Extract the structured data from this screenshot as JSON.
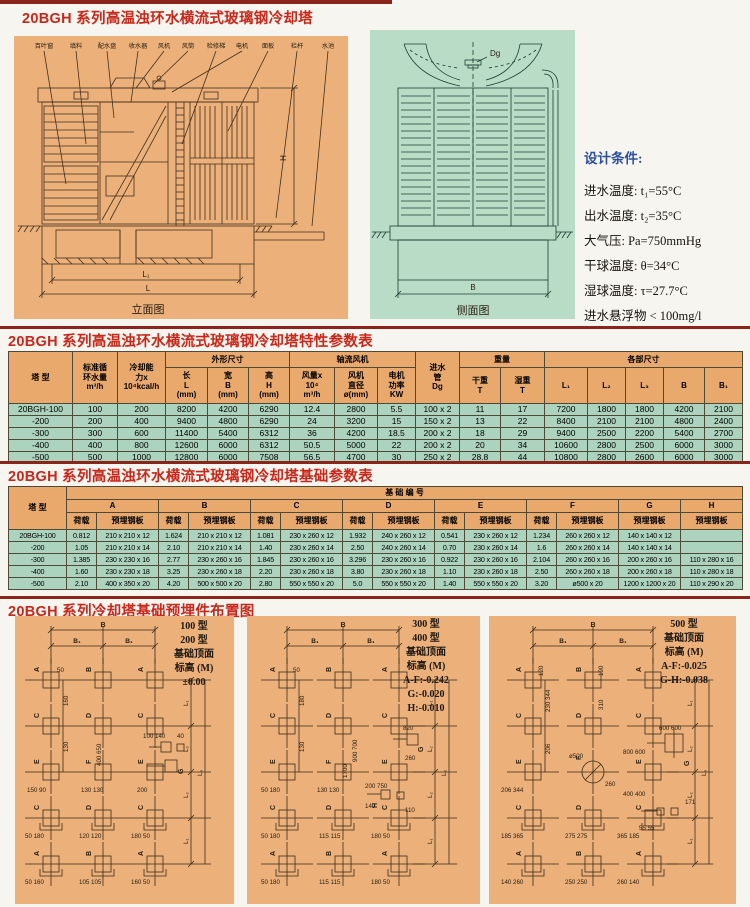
{
  "page": {
    "title1": "20BGH 系列高温浊环水横流式玻璃钢冷却塔",
    "title2": "20BGH 系列高温浊环水横流式玻璃钢冷却塔特性参数表",
    "title3": "20BGH 系列高温浊环水横流式玻璃钢冷却塔基础参数表",
    "title4": "20BGH 系列冷却塔基础预埋件布置图"
  },
  "colors": {
    "title_red": "#c9271a",
    "rule_red": "#8b241b",
    "panel_orange": "#ecb07a",
    "panel_green": "#b9dcc6",
    "table_header_orange": "#e9a96c",
    "table_cell_green": "#abd3bd",
    "heading_blue": "#2b50a1"
  },
  "elev": {
    "caption": "立面图",
    "labels": [
      "百叶窗",
      "填料",
      "配水盘",
      "收水器",
      "风机",
      "风筒",
      "检修梯",
      "电机",
      "面板",
      "栏杆",
      "水池"
    ],
    "dims": {
      "h": "H",
      "l1": "L₁",
      "l": "L"
    }
  },
  "side": {
    "caption": "侧面图",
    "dg": "Dg",
    "b": "B"
  },
  "cond": {
    "heading": "设计条件:",
    "lines": [
      "进水温度:  t₁=55°C",
      "出水温度:  t₂=35°C",
      "大气压:  Pa=750mmHg",
      "干球温度:  θ=34°C",
      "湿球温度:  τ=27.7°C",
      "进水悬浮物 < 100mg/l"
    ]
  },
  "t1": {
    "h": {
      "tower": "塔  型",
      "flow": "标准循\n环水量\nm³/h",
      "cooling": "冷却能\n力x\n10⁴kcal/h",
      "dims_group": "外形尺寸",
      "len": "长\nL\n(mm)",
      "wid": "宽\nB\n(mm)",
      "hgt": "高\nH\n(mm)",
      "fan_group": "轴流风机",
      "airflow": "风量x\n10⁴\nm³/h",
      "fan_dia": "风机\n直径\nø(mm)",
      "motor": "电机\n功率\nKW",
      "inlet": "进水\n管\nDg",
      "weight_group": "重量",
      "dry": "干重\nT",
      "wet": "湿重\nT",
      "parts_group": "各部尺寸",
      "l1": "L₁",
      "l2": "L₂",
      "l3": "L₃",
      "b": "B",
      "b1": "B₁"
    },
    "rows": [
      [
        "20BGH-100",
        "100",
        "200",
        "8200",
        "4200",
        "6290",
        "12.4",
        "2800",
        "5.5",
        "100 x 2",
        "11",
        "17",
        "7200",
        "1800",
        "1800",
        "4200",
        "2100"
      ],
      [
        "-200",
        "200",
        "400",
        "9400",
        "4800",
        "6290",
        "24",
        "3200",
        "15",
        "150 x 2",
        "13",
        "22",
        "8400",
        "2100",
        "2100",
        "4800",
        "2400"
      ],
      [
        "-300",
        "300",
        "600",
        "11400",
        "5400",
        "6312",
        "36",
        "4200",
        "18.5",
        "200 x 2",
        "18",
        "29",
        "9400",
        "2500",
        "2200",
        "5400",
        "2700"
      ],
      [
        "-400",
        "400",
        "800",
        "12600",
        "6000",
        "6312",
        "50.5",
        "5000",
        "22",
        "200 x 2",
        "20",
        "34",
        "10600",
        "2800",
        "2500",
        "6000",
        "3000"
      ],
      [
        "-500",
        "500",
        "1000",
        "12800",
        "6000",
        "7508",
        "56.5",
        "4700",
        "30",
        "250 x 2",
        "28.8",
        "44",
        "10800",
        "2800",
        "2600",
        "6000",
        "3000"
      ]
    ]
  },
  "t2": {
    "h": {
      "tower": "塔  型",
      "group": "基  础  编  号",
      "cols": [
        "A",
        "B",
        "C",
        "D",
        "E",
        "F",
        "G",
        "H"
      ],
      "load": "荷载",
      "plate": "预埋钢板"
    },
    "rows": [
      [
        "20BGH-100",
        "0.812",
        "210 x 210 x 12",
        "1.624",
        "210 x 210 x 12",
        "1.081",
        "230 x 260 x 12",
        "1.932",
        "240 x 260 x 12",
        "0.541",
        "230 x 260 x 12",
        "1.234",
        "260 x 260 x 12",
        "140 x 140 x 12",
        ""
      ],
      [
        "-200",
        "1.05",
        "210 x 210 x 14",
        "2.10",
        "210 x 210 x 14",
        "1.40",
        "230 x 260 x 14",
        "2.50",
        "240 x 260 x 14",
        "0.70",
        "230 x 260 x 14",
        "1.6",
        "260 x 260 x 14",
        "140 x 140 x 14",
        ""
      ],
      [
        "-300",
        "1.385",
        "230 x 230 x 16",
        "2.77",
        "230 x 260 x 16",
        "1.845",
        "230 x 260 x 16",
        "3.296",
        "230 x 260 x 16",
        "0.922",
        "230 x 260 x 16",
        "2.104",
        "260 x 260 x 16",
        "200 x 260 x 16",
        "110 x 280 x 16"
      ],
      [
        "-400",
        "1.60",
        "230 x 230 x 18",
        "3.25",
        "230 x 260 x 18",
        "2.20",
        "230 x 260 x 18",
        "3.80",
        "230 x 260 x 18",
        "1.10",
        "230 x 260 x 18",
        "2.50",
        "260 x 260 x 18",
        "200 x 260 x 18",
        "110 x 280 x 18"
      ],
      [
        "-500",
        "2.10",
        "400 x 350 x 20",
        "4.20",
        "500 x 500 x 20",
        "2.80",
        "550 x 550 x 20",
        "5.0",
        "550 x 550 x 20",
        "1.40",
        "550 x 550 x 20",
        "3.20",
        "ø500 x 20",
        "1200 x 1200 x 20",
        "110 x 290 x 20"
      ]
    ]
  },
  "diag": [
    {
      "side": [
        "100 型",
        "200 型",
        "基础顶面",
        "标高 (M)",
        "±0.00"
      ],
      "top": {
        "b": "B",
        "b1": "B₁"
      },
      "letters": [
        "A",
        "B",
        "A",
        "C",
        "D",
        "C",
        "E",
        "F",
        "E",
        "C",
        "D",
        "C",
        "A",
        "B",
        "A"
      ],
      "extra": [
        "G"
      ],
      "right": [
        "L₁",
        "L₂",
        "L₂",
        "L₁",
        "L₃"
      ],
      "nums": [
        "50",
        "160",
        "130",
        "150 90",
        "130 130",
        "200",
        "50 180",
        "120 120",
        "180 50",
        "50 160",
        "105 105",
        "160 50",
        "400 650",
        "100 140",
        "40"
      ]
    },
    {
      "side": [
        "300 型",
        "400 型",
        "基础顶面",
        "标高 (M)",
        "A-F:-0.242",
        "G:-0.020",
        "H:-0.010"
      ],
      "top": {
        "b": "B",
        "b1": "B₁"
      },
      "letters": [
        "A",
        "B",
        "A",
        "C",
        "D",
        "C",
        "E",
        "F",
        "E",
        "C",
        "D",
        "C",
        "A",
        "B",
        "A"
      ],
      "extra": [
        "G",
        "H"
      ],
      "right": [
        "L₁",
        "L₂",
        "L₂",
        "L₁",
        "L₃"
      ],
      "nums": [
        "50",
        "180",
        "130",
        "50 180",
        "130 130",
        "200 750",
        "820",
        "260",
        "110",
        "140",
        "900 700",
        "1700",
        "50 180",
        "115 115",
        "180 50",
        "50 180",
        "115 115",
        "180 50"
      ]
    },
    {
      "side": [
        "500 型",
        "基础顶面",
        "标高 (M)",
        "A-F:-0.025",
        "G-H:-0.038"
      ],
      "top": {
        "b": "B",
        "b1": "B₁"
      },
      "letters": [
        "A",
        "B",
        "A",
        "C",
        "D",
        "C",
        "E",
        "F",
        "E",
        "C",
        "D",
        "C",
        "A",
        "B",
        "A"
      ],
      "extra": [
        "G"
      ],
      "right": [
        "L₁",
        "L₂",
        "L₂",
        "L₁",
        "L₃"
      ],
      "nums": [
        "120",
        "190",
        "230 344",
        "310",
        "206",
        "ø500",
        "600 600",
        "800 600",
        "206 344",
        "260",
        "400 400",
        "171",
        "55 55",
        "185 365",
        "275 275",
        "365 185",
        "140 260",
        "250 250",
        "260 140"
      ]
    }
  ]
}
